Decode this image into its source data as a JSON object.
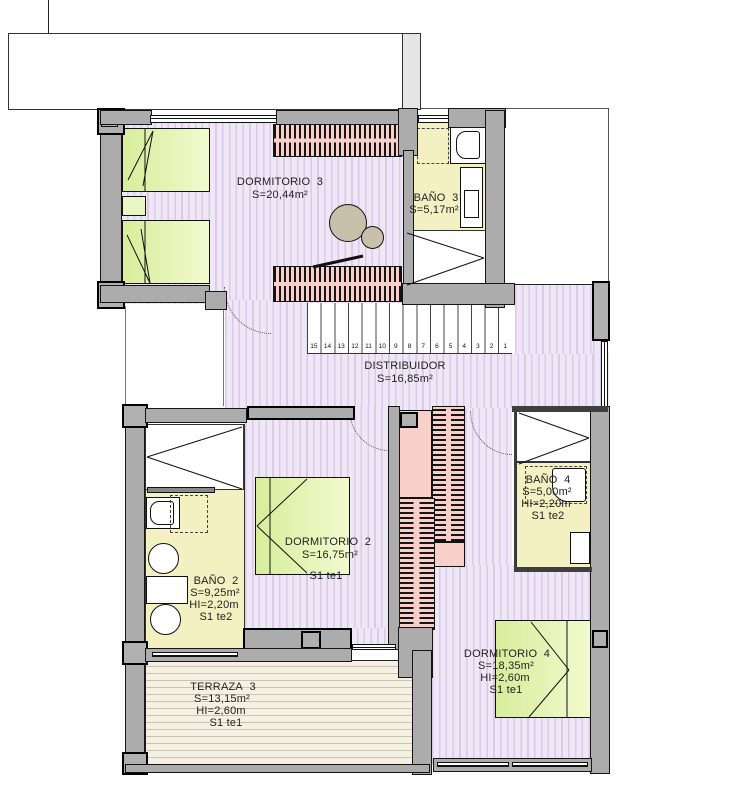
{
  "plan": {
    "rooms": {
      "dormitorio3": {
        "name": "DORMITORIO  3",
        "area": "S=20,44m²"
      },
      "bano3": {
        "name": "BAÑO  3",
        "area": "S=5,17m²"
      },
      "distribuidor": {
        "name": "DISTRIBUIDOR",
        "area": "S=16,85m²"
      },
      "dormitorio2": {
        "name": "DORMITORIO  2",
        "area": "S=16,75m²",
        "note": "S1 te1"
      },
      "bano2": {
        "name": "BAÑO  2",
        "area": "S=9,25m²",
        "height": "HI=2,20m",
        "note": "S1 te2"
      },
      "bano4": {
        "name": "BAÑO  4",
        "area": "S=5,00m²",
        "height": "HI=2,20m",
        "note": "S1 te2"
      },
      "dormitorio4": {
        "name": "DORMITORIO  4",
        "area": "S=18,35m²",
        "height": "HI=2,60m",
        "note": "S1 te1"
      },
      "terraza3": {
        "name": "TERRAZA  3",
        "area": "S=13,15m²",
        "height": "HI=2,60m",
        "note": "S1 te1"
      }
    },
    "stairs": {
      "numbers": [
        "15",
        "14",
        "13",
        "12",
        "11",
        "10",
        "9",
        "8",
        "7",
        "6",
        "5",
        "4",
        "3",
        "2",
        "1"
      ]
    },
    "colors": {
      "wall_gray": "#ACACAC",
      "floor_lavender": "#EFE7F6",
      "floor_stripe": "#D9CBE8",
      "bathroom_yellow": "#F3F0C2",
      "terrace_cream": "#F4F1E3",
      "furniture_green": "#E4F3A8",
      "wardrobe_pink": "#F8CFC9",
      "plant_tan": "#C9C0AB"
    }
  }
}
